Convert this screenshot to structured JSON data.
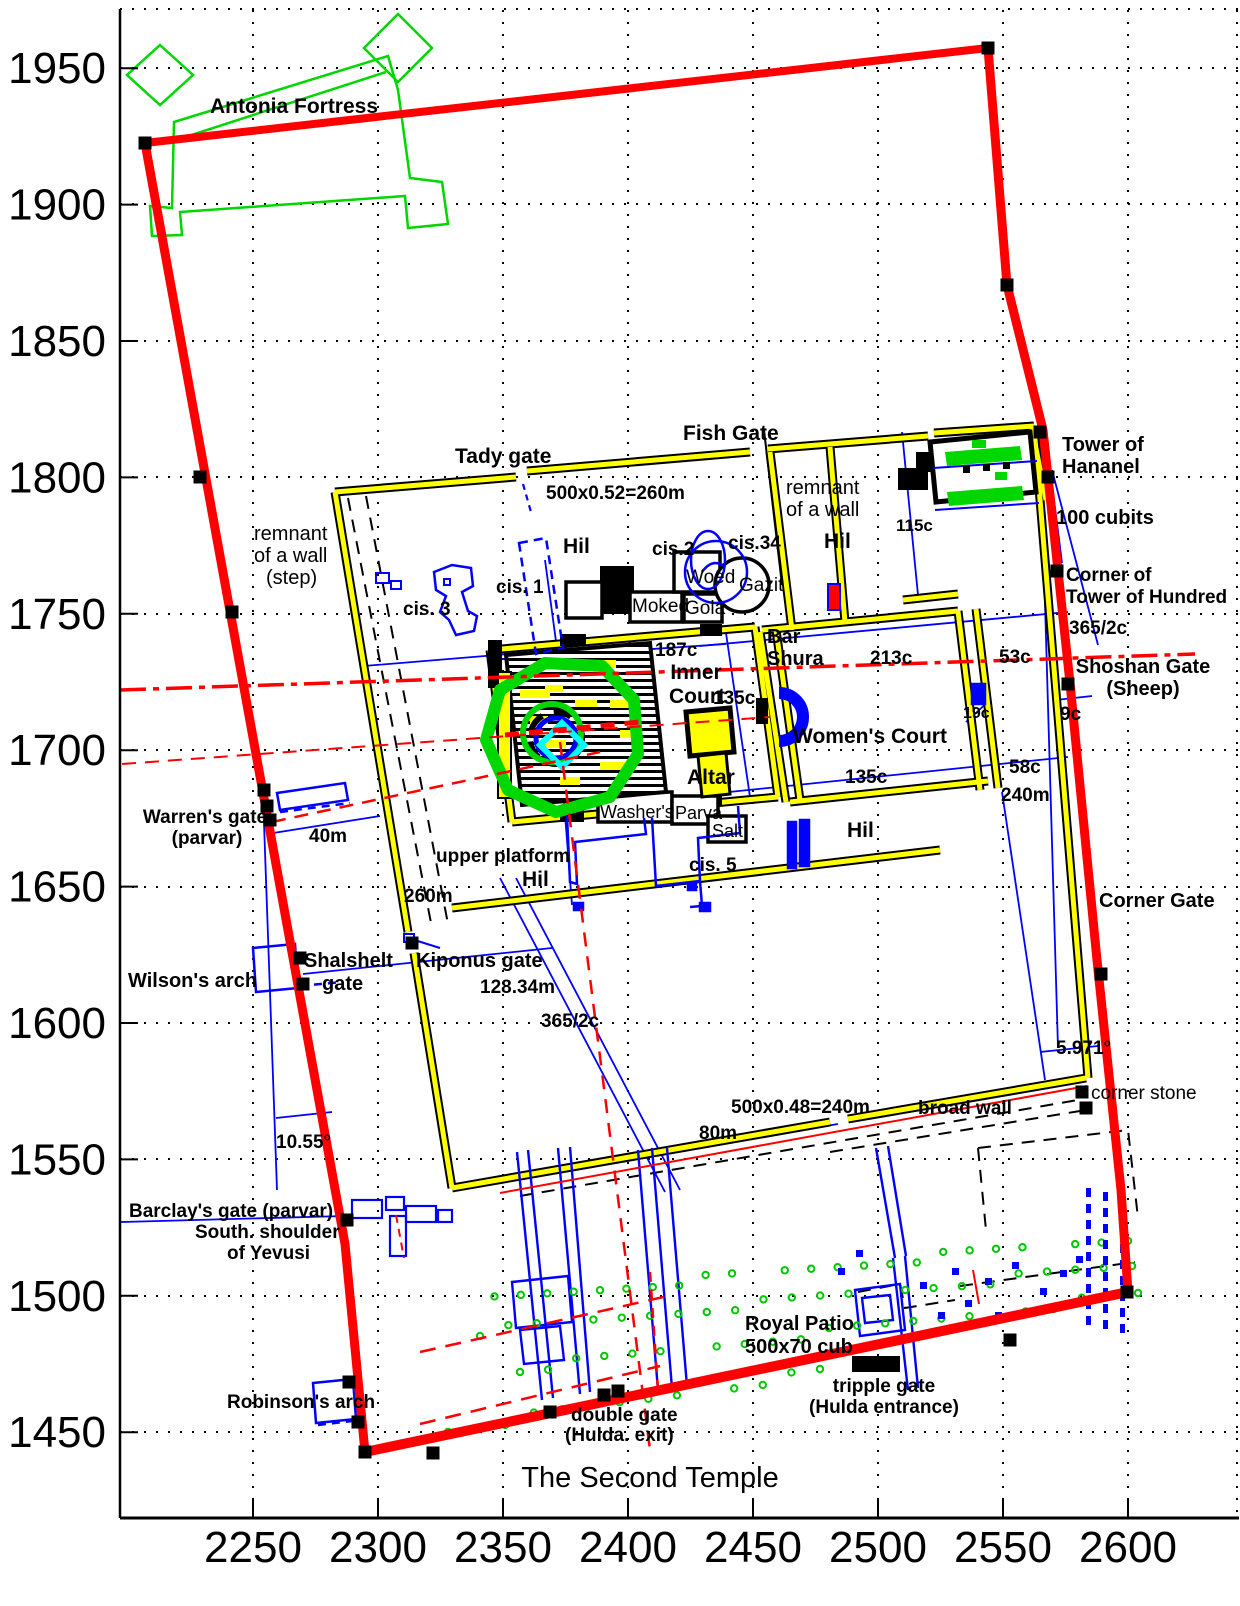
{
  "title": "The Second Temple",
  "axes": {
    "x_ticks": [
      "2250",
      "2300",
      "2350",
      "2400",
      "2450",
      "2500",
      "2550",
      "2600"
    ],
    "y_ticks": [
      "1950",
      "1900",
      "1850",
      "1800",
      "1750",
      "1700",
      "1650",
      "1600",
      "1550",
      "1500",
      "1450"
    ]
  },
  "colors": {
    "wall_red": "#ff0000",
    "wall_yellow": "#ffff00",
    "detail_blue": "#0000ff",
    "feature_green": "#00d700",
    "ring_cyan": "#00ffff",
    "ink_black": "#000000"
  },
  "labels": [
    {
      "name": "label-antonia-fortress",
      "t": "Antonia Fortress",
      "x": 210,
      "y": 113,
      "s": 21,
      "b": 1
    },
    {
      "name": "label-tady-gate",
      "t": "Tady gate",
      "x": 455,
      "y": 463,
      "s": 21,
      "b": 1
    },
    {
      "name": "label-fish-gate",
      "t": "Fish Gate",
      "x": 683,
      "y": 440,
      "s": 21,
      "b": 1
    },
    {
      "name": "label-north-wall-measure",
      "t": "500x0.52=260m",
      "x": 546,
      "y": 499,
      "s": 19,
      "b": 1
    },
    {
      "name": "label-remnant-ne-1",
      "t": "remnant",
      "x": 786,
      "y": 494,
      "s": 20,
      "b": 0
    },
    {
      "name": "label-remnant-ne-2",
      "t": "of a wall",
      "x": 786,
      "y": 516,
      "s": 20,
      "b": 0
    },
    {
      "name": "label-hil-nw",
      "t": "Hil",
      "x": 563,
      "y": 553,
      "s": 21,
      "b": 1
    },
    {
      "name": "label-hil-ne",
      "t": "Hil",
      "x": 824,
      "y": 548,
      "s": 21,
      "b": 1
    },
    {
      "name": "label-115c",
      "t": "115c",
      "x": 896,
      "y": 531,
      "s": 17,
      "b": 1
    },
    {
      "name": "label-tower-of-hananel-1",
      "t": "Tower of",
      "x": 1062,
      "y": 451,
      "s": 20,
      "b": 1
    },
    {
      "name": "label-tower-of-hananel-2",
      "t": "Hananel",
      "x": 1062,
      "y": 473,
      "s": 20,
      "b": 1
    },
    {
      "name": "label-100-cubits",
      "t": "100 cubits",
      "x": 1056,
      "y": 524,
      "s": 20,
      "b": 1
    },
    {
      "name": "label-corner-of-tower-1",
      "t": "Corner of",
      "x": 1066,
      "y": 581,
      "s": 19,
      "b": 1
    },
    {
      "name": "label-corner-of-tower-2",
      "t": "Tower of Hundred",
      "x": 1066,
      "y": 603,
      "s": 19,
      "b": 1
    },
    {
      "name": "label-365-2c-east",
      "t": "365/2c",
      "x": 1069,
      "y": 634,
      "s": 19,
      "b": 1
    },
    {
      "name": "label-remnant-w-1",
      "t": "remnant",
      "x": 254,
      "y": 540,
      "s": 20,
      "b": 0
    },
    {
      "name": "label-remnant-w-2",
      "t": "of a wall",
      "x": 254,
      "y": 562,
      "s": 20,
      "b": 0
    },
    {
      "name": "label-remnant-w-3",
      "t": "(step)",
      "x": 266,
      "y": 584,
      "s": 20,
      "b": 0
    },
    {
      "name": "label-cis-3",
      "t": "cis. 3",
      "x": 403,
      "y": 615,
      "s": 19,
      "b": 1
    },
    {
      "name": "label-cis-1",
      "t": "cis. 1",
      "x": 496,
      "y": 593,
      "s": 19,
      "b": 1
    },
    {
      "name": "label-cis-2",
      "t": "cis.2",
      "x": 652,
      "y": 555,
      "s": 19,
      "b": 1
    },
    {
      "name": "label-cis-34",
      "t": "cis.34",
      "x": 728,
      "y": 549,
      "s": 19,
      "b": 1
    },
    {
      "name": "label-woed",
      "t": "Woed",
      "x": 686,
      "y": 583,
      "s": 19,
      "b": 0
    },
    {
      "name": "label-gazit",
      "t": "Gazit",
      "x": 739,
      "y": 591,
      "s": 19,
      "b": 0
    },
    {
      "name": "label-moked",
      "t": "Moked",
      "x": 632,
      "y": 612,
      "s": 19,
      "b": 0
    },
    {
      "name": "label-gola",
      "t": "Gola",
      "x": 685,
      "y": 614,
      "s": 19,
      "b": 0
    },
    {
      "name": "label-bar-shura-1",
      "t": "Bar",
      "x": 767,
      "y": 643,
      "s": 20,
      "b": 1
    },
    {
      "name": "label-bar-shura-2",
      "t": "Shura",
      "x": 767,
      "y": 665,
      "s": 20,
      "b": 1
    },
    {
      "name": "label-187c",
      "t": "187c",
      "x": 655,
      "y": 656,
      "s": 19,
      "b": 1
    },
    {
      "name": "label-inner-court-1",
      "t": "Inner",
      "x": 696,
      "y": 679,
      "a": "middle",
      "s": 21,
      "b": 1
    },
    {
      "name": "label-inner-court-2",
      "t": "Court",
      "x": 697,
      "y": 703,
      "a": "middle",
      "s": 21,
      "b": 1
    },
    {
      "name": "label-135c-west",
      "t": "135c",
      "x": 713,
      "y": 704,
      "s": 19,
      "b": 1
    },
    {
      "name": "label-213c",
      "t": "213c",
      "x": 870,
      "y": 664,
      "s": 19,
      "b": 1
    },
    {
      "name": "label-53c",
      "t": "53c",
      "x": 999,
      "y": 663,
      "s": 19,
      "b": 1
    },
    {
      "name": "label-shoshan-gate-1",
      "t": "Shoshan Gate",
      "x": 1143,
      "y": 673,
      "a": "middle",
      "s": 20,
      "b": 1
    },
    {
      "name": "label-shoshan-gate-2",
      "t": "(Sheep)",
      "x": 1143,
      "y": 695,
      "a": "middle",
      "s": 20,
      "b": 1
    },
    {
      "name": "label-womens-court",
      "t": "Women's Court",
      "x": 793,
      "y": 743,
      "s": 21,
      "b": 1
    },
    {
      "name": "label-19c",
      "t": "19c",
      "x": 963,
      "y": 718,
      "s": 16,
      "b": 1
    },
    {
      "name": "label-9c",
      "t": "9c",
      "x": 1060,
      "y": 720,
      "s": 19,
      "b": 1
    },
    {
      "name": "label-135c-south",
      "t": "135c",
      "x": 845,
      "y": 783,
      "s": 19,
      "b": 1
    },
    {
      "name": "label-58c",
      "t": "58c",
      "x": 1009,
      "y": 773,
      "s": 19,
      "b": 1
    },
    {
      "name": "label-240m",
      "t": "240m",
      "x": 1001,
      "y": 801,
      "s": 19,
      "b": 1
    },
    {
      "name": "label-altar",
      "t": "Altar",
      "x": 687,
      "y": 784,
      "s": 21,
      "b": 1
    },
    {
      "name": "label-washers",
      "t": "Washer's",
      "x": 600,
      "y": 818,
      "s": 18,
      "b": 0
    },
    {
      "name": "label-parva",
      "t": "Parva",
      "x": 675,
      "y": 819,
      "s": 18,
      "b": 0
    },
    {
      "name": "label-salt",
      "t": "Salt",
      "x": 712,
      "y": 837,
      "s": 18,
      "b": 0
    },
    {
      "name": "label-cis-5",
      "t": "cis. 5",
      "x": 689,
      "y": 871,
      "s": 19,
      "b": 1
    },
    {
      "name": "label-hil-east",
      "t": "Hil",
      "x": 847,
      "y": 837,
      "s": 21,
      "b": 1
    },
    {
      "name": "label-warrens-gate-1",
      "t": "Warren's gate",
      "x": 205,
      "y": 823,
      "a": "middle",
      "s": 19,
      "b": 1
    },
    {
      "name": "label-warrens-gate-2",
      "t": "(parvar)",
      "x": 207,
      "y": 844,
      "a": "middle",
      "s": 19,
      "b": 1
    },
    {
      "name": "label-40m",
      "t": "40m",
      "x": 309,
      "y": 842,
      "s": 19,
      "b": 1
    },
    {
      "name": "label-upper-platform",
      "t": "upper platform",
      "x": 436,
      "y": 862,
      "s": 19,
      "b": 1
    },
    {
      "name": "label-hil-center",
      "t": "Hil",
      "x": 522,
      "y": 886,
      "s": 21,
      "b": 1
    },
    {
      "name": "label-260m",
      "t": "260m",
      "x": 404,
      "y": 902,
      "s": 19,
      "b": 1
    },
    {
      "name": "label-wilsons-arch",
      "t": "Wilson's arch",
      "x": 128,
      "y": 987,
      "s": 20,
      "b": 1
    },
    {
      "name": "label-shalshelt-1",
      "t": "Shalshelt",
      "x": 304,
      "y": 967,
      "s": 20,
      "b": 1
    },
    {
      "name": "label-shalshelt-2",
      "t": "gate",
      "x": 322,
      "y": 990,
      "s": 20,
      "b": 1
    },
    {
      "name": "label-kiponus-gate",
      "t": "Kiponus gate",
      "x": 416,
      "y": 967,
      "s": 20,
      "b": 1
    },
    {
      "name": "label-12834m",
      "t": "128.34m",
      "x": 480,
      "y": 993,
      "s": 19,
      "b": 1
    },
    {
      "name": "label-365-2c-west",
      "t": "365/2c",
      "x": 541,
      "y": 1027,
      "s": 19,
      "b": 1
    },
    {
      "name": "label-corner-gate",
      "t": "Corner Gate",
      "x": 1099,
      "y": 907,
      "s": 20,
      "b": 1
    },
    {
      "name": "label-5971deg",
      "t": "5.971°",
      "x": 1056,
      "y": 1054,
      "s": 19,
      "b": 1
    },
    {
      "name": "label-south-wall-measure",
      "t": "500x0.48=240m",
      "x": 731,
      "y": 1113,
      "s": 19,
      "b": 1
    },
    {
      "name": "label-80m",
      "t": "80m",
      "x": 699,
      "y": 1139,
      "s": 19,
      "b": 1
    },
    {
      "name": "label-broad-wall",
      "t": "broad wall",
      "x": 918,
      "y": 1114,
      "s": 19,
      "b": 1
    },
    {
      "name": "label-corner-stone",
      "t": "corner stone",
      "x": 1091,
      "y": 1099,
      "s": 19,
      "b": 0
    },
    {
      "name": "label-1055deg",
      "t": "10.55°",
      "x": 276,
      "y": 1148,
      "s": 19,
      "b": 1
    },
    {
      "name": "label-barclays-gate",
      "t": "Barclay's gate (parvar)",
      "x": 129,
      "y": 1217,
      "s": 19,
      "b": 1
    },
    {
      "name": "label-south-shoulder-1",
      "t": "South. shoulder",
      "x": 195,
      "y": 1238,
      "s": 19,
      "b": 1
    },
    {
      "name": "label-south-shoulder-2",
      "t": "of Yevusi",
      "x": 227,
      "y": 1259,
      "s": 19,
      "b": 1
    },
    {
      "name": "label-royal-patio",
      "t": "Royal Patio",
      "x": 745,
      "y": 1330,
      "s": 20,
      "b": 1
    },
    {
      "name": "label-500x70-cub",
      "t": "500x70 cub",
      "x": 745,
      "y": 1353,
      "s": 20,
      "b": 1
    },
    {
      "name": "label-tripple-gate-1",
      "t": "tripple gate",
      "x": 884,
      "y": 1392,
      "a": "middle",
      "s": 19,
      "b": 1
    },
    {
      "name": "label-tripple-gate-2",
      "t": "(Hulda entrance)",
      "x": 884,
      "y": 1413,
      "a": "middle",
      "s": 19,
      "b": 1
    },
    {
      "name": "label-robinsons-arch",
      "t": "Robinson's arch",
      "x": 227,
      "y": 1408,
      "s": 19,
      "b": 1
    },
    {
      "name": "label-double-gate-1",
      "t": "double gate",
      "x": 571,
      "y": 1421,
      "s": 19,
      "b": 1
    },
    {
      "name": "label-double-gate-2",
      "t": "(Hulda. exit)",
      "x": 565,
      "y": 1441,
      "s": 19,
      "b": 1
    },
    {
      "name": "plot-title",
      "t": "The Second Temple",
      "x": 650,
      "y": 1487,
      "a": "middle",
      "s": 29,
      "b": 0
    }
  ]
}
